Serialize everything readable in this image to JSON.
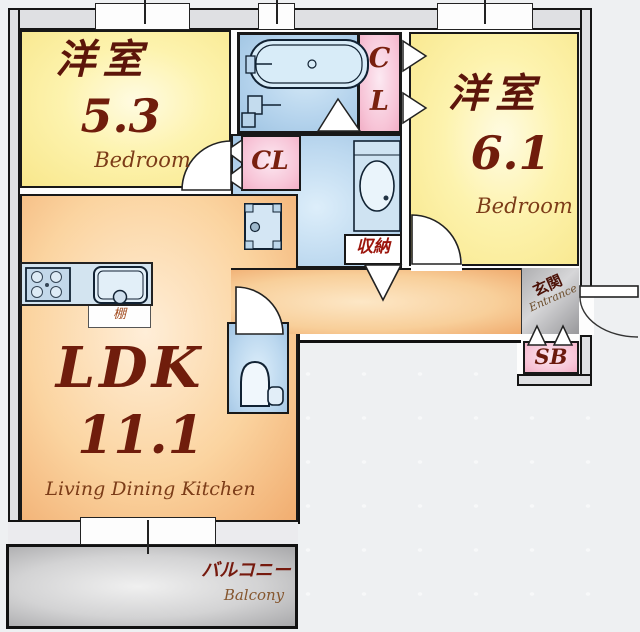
{
  "plan_title": "apartment-floor-plan",
  "rooms": {
    "bedroom_a": {
      "name": "洋室",
      "area": "5.3",
      "type_en": "Bedroom"
    },
    "bedroom_b": {
      "name": "洋室",
      "area": "6.1",
      "type_en": "Bedroom"
    },
    "ldk": {
      "name": "LDK",
      "area": "11.1",
      "type_en": "Living Dining Kitchen"
    },
    "closet_a": {
      "label": "CL"
    },
    "closet_b": {
      "line1": "C",
      "line2": "L"
    },
    "storage": {
      "label": "収納"
    },
    "entrance": {
      "label": "玄関",
      "label_en": "Entrance"
    },
    "shoe_box": {
      "label": "SB"
    },
    "balcony": {
      "label": "バルコニー",
      "label_en": "Balcony"
    },
    "shelf": {
      "label": "棚"
    }
  },
  "fixtures": [
    "bathtub-icon",
    "shower-mixer-icon",
    "bath-drain-icon",
    "washbasin-vanity-icon",
    "washing-machine-pan-icon",
    "toilet-icon",
    "gas-stove-icon",
    "kitchen-sink-icon"
  ],
  "colors": {
    "room_yellow": "#fdf3ae",
    "room_orange": "#f4b87e",
    "water_blue": "#b3d2ec",
    "closet_pink": "#f7c3d6",
    "entrance_gray": "#a8a8a8",
    "balcony_gray": "#b5b5b5",
    "text_maroon": "#5c150a",
    "text_brown": "#7c3c18",
    "storage_red": "#9c150c",
    "wall_black": "#151515"
  }
}
